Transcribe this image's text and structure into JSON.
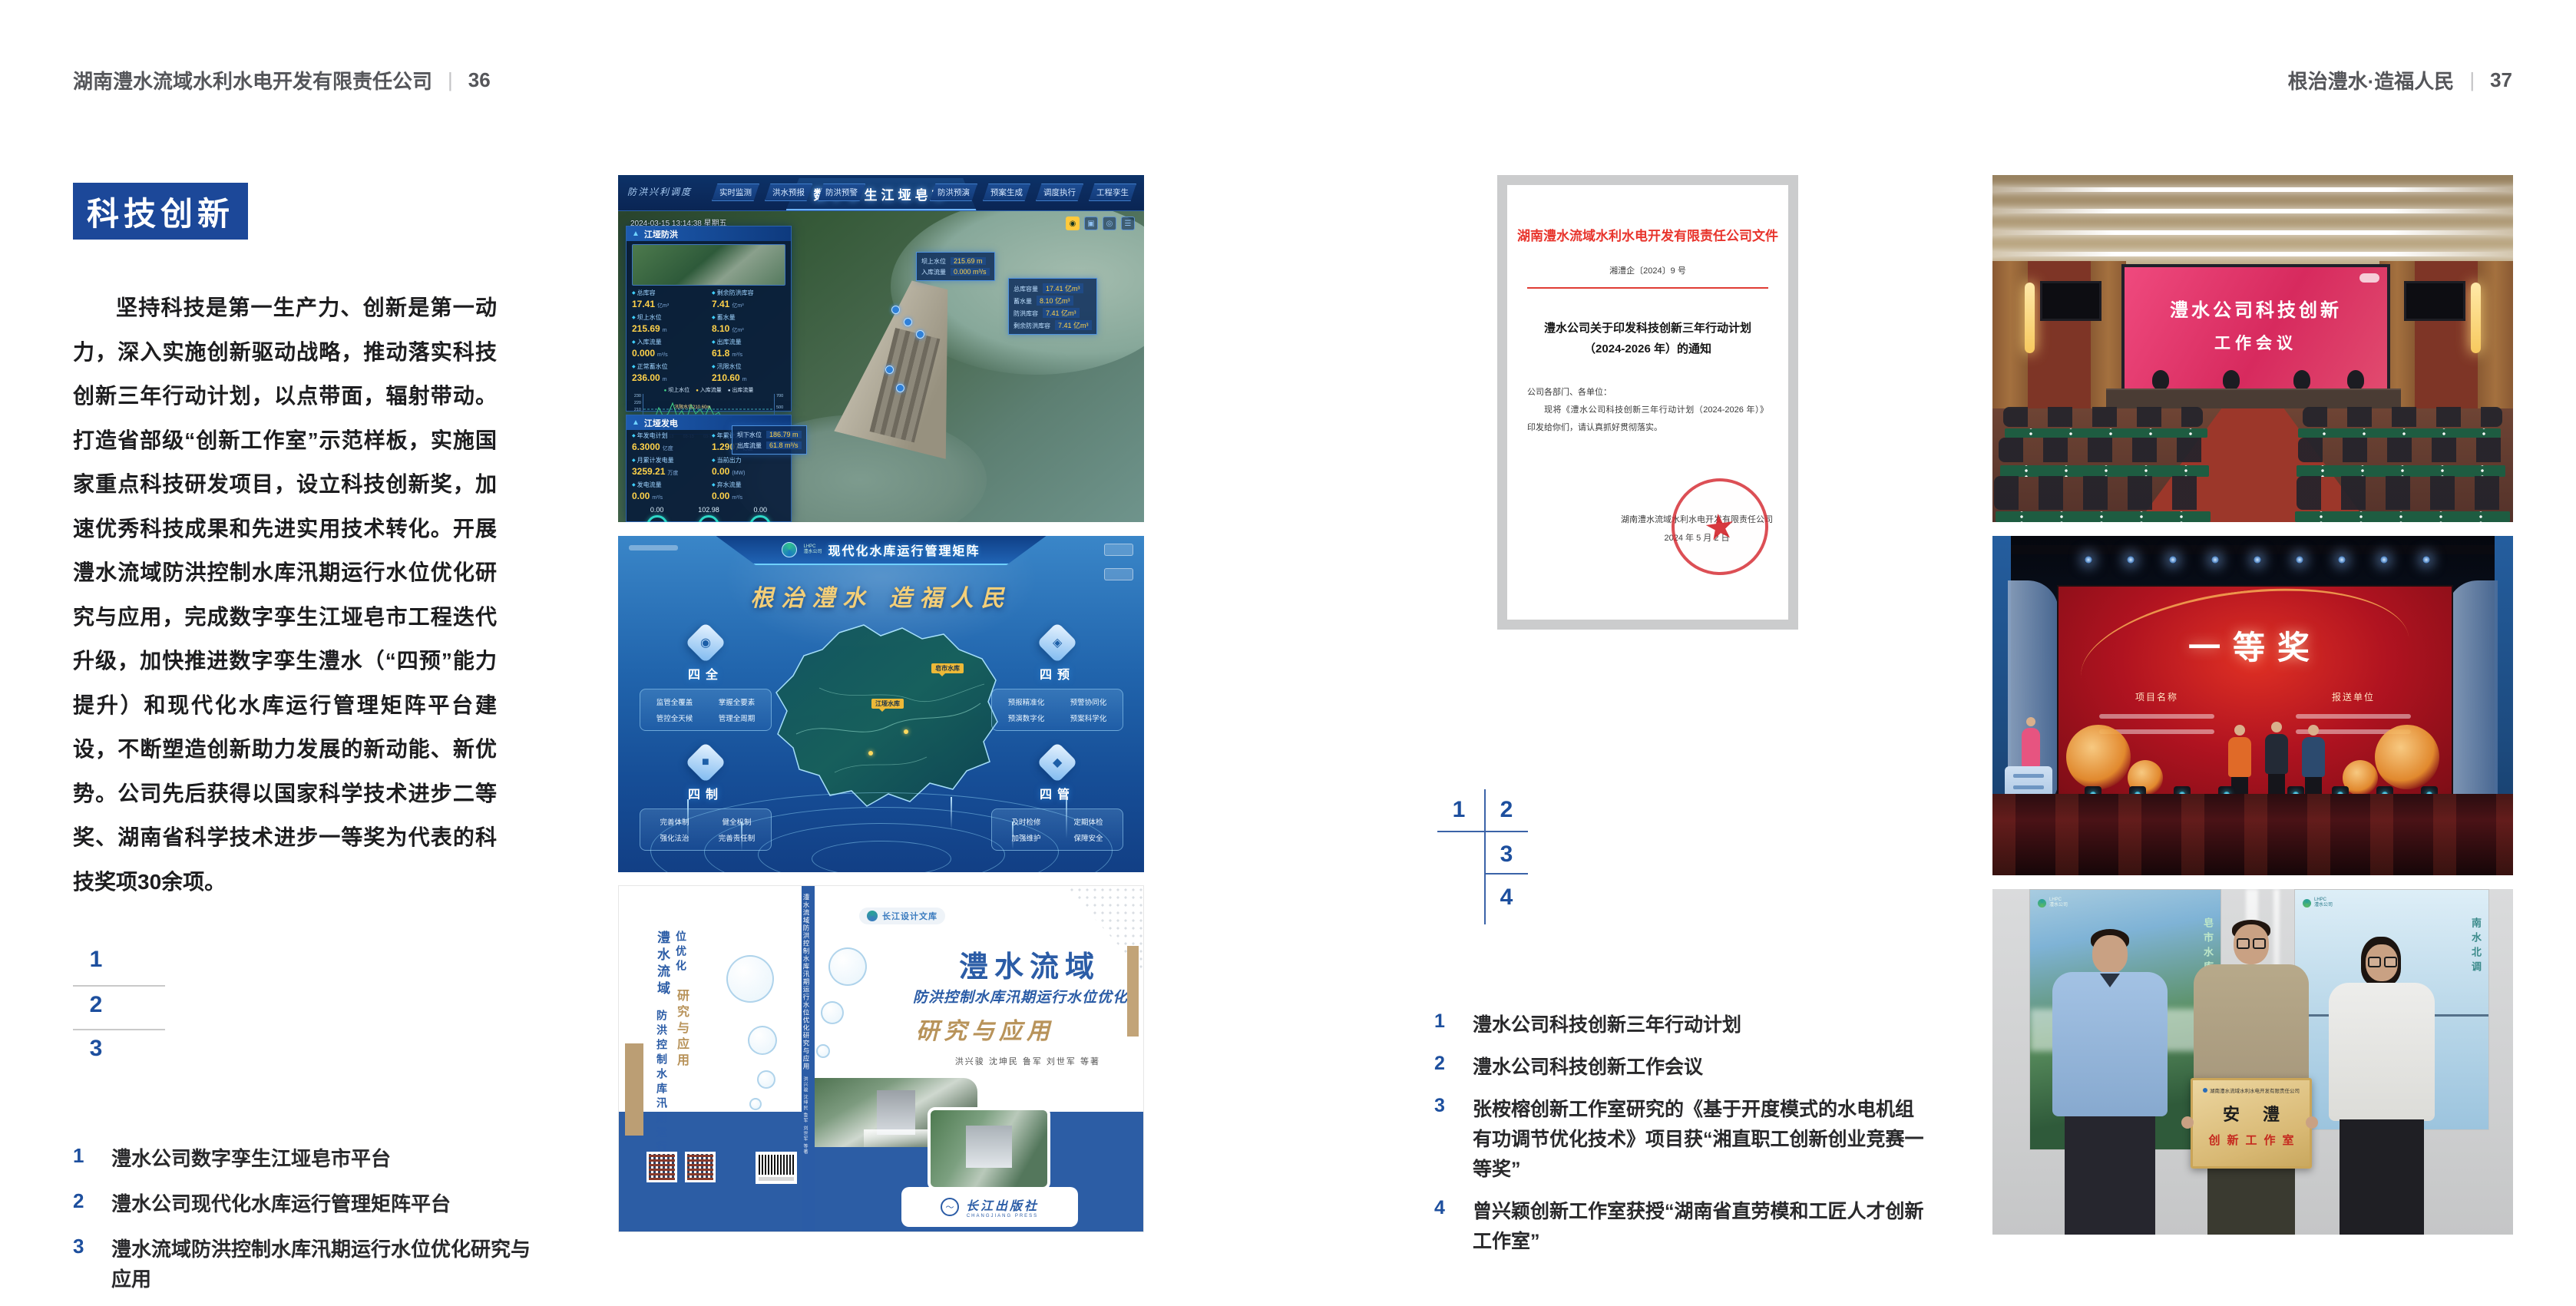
{
  "meta": {
    "page_bg": "#ffffff",
    "accent_blue": "#1c4899",
    "caption_blue": "#1d4f9e",
    "doc_red": "#e8342c",
    "tan": "#b8935a"
  },
  "left_page": {
    "header": {
      "company": "湖南澧水流域水利水电开发有限责任公司",
      "separator": "|",
      "page_number": "36"
    },
    "section_badge": "科技创新",
    "paragraph": "坚持科技是第一生产力、创新是第一动力，深入实施创新驱动战略，推动落实科技创新三年行动计划，以点带面，辐射带动。打造省部级“创新工作室”示范样板，实施国家重点科技研发项目，设立科技创新奖，加速优秀科技成果和先进实用技术转化。开展澧水流域防洪控制水库汛期运行水位优化研究与应用，完成数字孪生江垭皂市工程迭代升级，加快推进数字孪生澧水（“四预”能力提升）和现代化水库运行管理矩阵平台建设，不断塑造创新助力发展的新动能、新优势。公司先后获得以国家科学技术进步二等奖、湖南省科学技术进步一等奖为代表的科技奖项30余项。",
    "figure_keys": [
      "1",
      "2",
      "3"
    ],
    "captions": [
      {
        "num": "1",
        "text": "澧水公司数字孪生江垭皂市平台"
      },
      {
        "num": "2",
        "text": "澧水公司现代化水库运行管理矩阵平台"
      },
      {
        "num": "3",
        "text": "澧水流域防洪控制水库汛期运行水位优化研究与应用"
      }
    ]
  },
  "right_page": {
    "header": {
      "motto": "根治澧水·造福人民",
      "separator": "|",
      "page_number": "37"
    },
    "figure_keys": [
      "1",
      "2",
      "3",
      "4"
    ],
    "captions": [
      {
        "num": "1",
        "text": "澧水公司科技创新三年行动计划"
      },
      {
        "num": "2",
        "text": "澧水公司科技创新工作会议"
      },
      {
        "num": "3",
        "text": "张桉榕创新工作室研究的《基于开度模式的水电机组有功调节优化技术》项目获“湘直职工创新创业竞赛一等奖”"
      },
      {
        "num": "4",
        "text": "曾兴颖创新工作室获授“湖南省直劳模和工匠人才创新工作室”"
      }
    ]
  },
  "document_figure": {
    "title": "湖南澧水流域水利水电开发有限责任公司文件",
    "doc_number": "湘澧企〔2024〕9 号",
    "subject_line1": "澧水公司关于印发科技创新三年行动计划",
    "subject_line2": "（2024-2026 年）的通知",
    "salutation": "公司各部门、各单位：",
    "body": "现将《澧水公司科技创新三年行动计划（2024-2026 年）》印发给你们，请认真抓好贯彻落实。",
    "signer": "湖南澧水流域水利水电开发有限责任公司",
    "date": "2024 年 5 月 2 日"
  },
  "digital_twin": {
    "corner_label": "防洪兴利调度",
    "title": "数字孪生江垭皂市",
    "tabs_left": [
      "实时监测",
      "洪水预报",
      "防洪预警"
    ],
    "tabs_right": [
      "防洪预演",
      "预案生成",
      "调度执行",
      "工程孪生"
    ],
    "datetime": "2024-03-15 13:14:38 星期五",
    "panel1": {
      "title": "江垭防洪",
      "stats": [
        {
          "label": "总库容",
          "value": "17.41",
          "unit": "亿m³"
        },
        {
          "label": "剩余防洪库容",
          "value": "7.41",
          "unit": "亿m³"
        },
        {
          "label": "坝上水位",
          "value": "215.69",
          "unit": "m"
        },
        {
          "label": "蓄水量",
          "value": "8.10",
          "unit": "亿m³"
        },
        {
          "label": "入库流量",
          "value": "0.000",
          "unit": "m³/s"
        },
        {
          "label": "出库流量",
          "value": "61.8",
          "unit": "m³/s"
        },
        {
          "label": "正常蓄水位",
          "value": "236.00",
          "unit": "m"
        },
        {
          "label": "汛限水位",
          "value": "210.60",
          "unit": "m"
        }
      ],
      "chart": {
        "legend": [
          "坝上水位",
          "入库流量",
          "出库流量"
        ],
        "y_left": [
          "230",
          "220",
          "210",
          "200",
          "190",
          "180"
        ],
        "y_right": [
          "700",
          "500",
          "300",
          "100"
        ],
        "x": [
          "03-12",
          "03-13",
          "03-13",
          "03-13",
          "03-13",
          "03-14",
          "03-14"
        ],
        "annotation": "汛限水位210.60m"
      }
    },
    "panel2": {
      "title": "江垭发电",
      "stats": [
        {
          "label": "年发电计划",
          "value": "6.3000",
          "unit": "亿度"
        },
        {
          "label": "年累计发电量",
          "value": "1.2907",
          "unit": "亿度"
        },
        {
          "label": "月累计发电量",
          "value": "3259.21",
          "unit": "万度"
        },
        {
          "label": "当前出力",
          "value": "0.00",
          "unit": "(MW)"
        },
        {
          "label": "发电流量",
          "value": "0.00",
          "unit": "m³/s"
        },
        {
          "label": "弃水流量",
          "value": "0.00",
          "unit": "m³/s"
        }
      ],
      "gauges": [
        {
          "value": "0.00",
          "label": "1#机组"
        },
        {
          "value": "102.98",
          "label": "2#机组"
        },
        {
          "value": "0.00",
          "label": "3#机组"
        }
      ]
    },
    "tooltip_top": {
      "rows": [
        {
          "label": "坝上水位",
          "value": "215.69 m"
        },
        {
          "label": "入库流量",
          "value": "0.000 m³/s"
        }
      ]
    },
    "tooltip_right": {
      "rows": [
        {
          "label": "总库容量",
          "value": "17.41 亿m³"
        },
        {
          "label": "蓄水量",
          "value": "8.10 亿m³"
        },
        {
          "label": "防洪库容",
          "value": "7.41 亿m³"
        },
        {
          "label": "剩余防洪库容",
          "value": "7.41 亿m³"
        }
      ]
    },
    "tooltip_bottom": {
      "rows": [
        {
          "label": "坝下水位",
          "value": "186.79 m"
        },
        {
          "label": "出库流量",
          "value": "61.8 m³/s"
        }
      ]
    }
  },
  "matrix_platform": {
    "logo_line1": "LHPC",
    "logo_line2": "澧水公司",
    "title": "现代化水库运行管理矩阵",
    "slogan": "根治澧水 造福人民",
    "groups": {
      "tl": {
        "name": "四全",
        "items": [
          "监管全覆盖",
          "掌握全要素",
          "管控全天候",
          "管理全周期"
        ]
      },
      "tr": {
        "name": "四预",
        "items": [
          "预报精准化",
          "预警协同化",
          "预演数字化",
          "预案科学化"
        ]
      },
      "bl": {
        "name": "四制",
        "items": [
          "完善体制",
          "健全机制",
          "强化法治",
          "完善责任制"
        ]
      },
      "br": {
        "name": "四管",
        "items": [
          "及时检修",
          "定期体检",
          "加强维护",
          "保障安全"
        ]
      }
    },
    "markers": [
      {
        "label": "皂市水库"
      },
      {
        "label": "江垭水库"
      }
    ]
  },
  "book_cover": {
    "series_label": "长江设计文库",
    "title_main": "澧水流域",
    "title_sub": "防洪控制水库汛期运行水位优化",
    "title_tail": "研究与应用",
    "authors": "洪兴骏 沈坤民 鲁军 刘世军 等著",
    "publisher": "长江出版社",
    "publisher_en": "CHANGJIANG PRESS",
    "spine_title": "澧水流域防洪控制水库汛期运行水位优化研究与应用",
    "spine_authors": "洪兴骏 沈坤民 鲁军 刘世军 等著",
    "back_title_main": "澧水流域",
    "back_title_sub": "防洪控制水库汛期运行水位优化",
    "back_title_tail": "研究与应用"
  },
  "meeting_photo": {
    "screen_line1": "澧水公司科技创新",
    "screen_line2": "工作会议"
  },
  "award_photo": {
    "award_title": "一等奖",
    "column1_header": "项目名称",
    "column2_header": "报送单位"
  },
  "plaque_photo": {
    "plaque_org": "湖南澧水流域水利水电开发有限责任公司",
    "plaque_name": "安澧",
    "plaque_sub": "创新工作室",
    "poster_left_logo_line1": "LHPC",
    "poster_left_logo_line2": "澧水公司",
    "poster_left_caption": "皂市水库",
    "poster_right_logo_line1": "LHPC",
    "poster_right_logo_line2": "澧水公司",
    "poster_right_caption": "南水北调"
  }
}
